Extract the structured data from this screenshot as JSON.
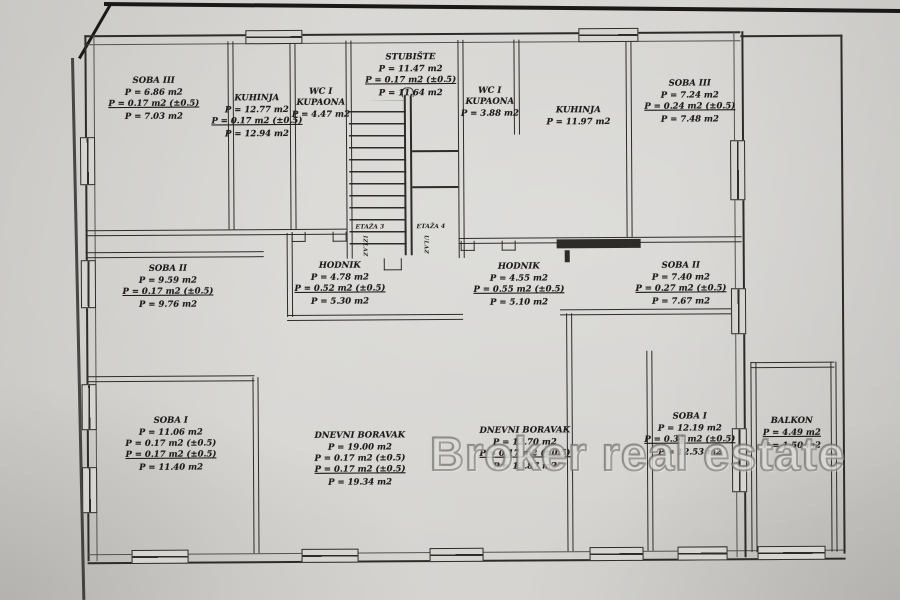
{
  "watermark": {
    "text": "Broker real estate"
  },
  "stairwell_annotations": {
    "left_floor": "ETAŽA 3",
    "left_dir": "IZLAZ",
    "right_floor": "ETAŽA 4",
    "right_dir": "ULAZ"
  },
  "rooms": {
    "soba3_left": {
      "name": "SOBA III",
      "lines": [
        "P = 6.86 m2",
        "P = 0.17 m2 (±0.5)",
        "P = 7.03 m2"
      ]
    },
    "kuhinja_left": {
      "name": "KUHINJA",
      "lines": [
        "P = 12.77 m2",
        "P = 0.17 m2 (±0.5)",
        "P = 12.94 m2"
      ]
    },
    "wc_left": {
      "name": "WC I\nKUPAONA",
      "lines": [
        "P = 4.47 m2"
      ]
    },
    "stubiste": {
      "name": "STUBIŠTE",
      "lines": [
        "P = 11.47 m2",
        "P = 0.17 m2 (±0.5)",
        "P = 11.64 m2"
      ]
    },
    "wc_right": {
      "name": "WC I\nKUPAONA",
      "lines": [
        "P = 3.88 m2"
      ]
    },
    "kuhinja_right": {
      "name": "KUHINJA",
      "lines": [
        "P = 11.97 m2"
      ]
    },
    "soba3_right": {
      "name": "SOBA III",
      "lines": [
        "P = 7.24 m2",
        "P = 0.24 m2 (±0.5)",
        "P = 7.48 m2"
      ]
    },
    "hodnik_left": {
      "name": "HODNIK",
      "lines": [
        "P = 4.78 m2",
        "P = 0.52 m2 (±0.5)",
        "P = 5.30 m2"
      ]
    },
    "hodnik_right": {
      "name": "HODNIK",
      "lines": [
        "P = 4.55 m2",
        "P = 0.55 m2 (±0.5)",
        "P = 5.10 m2"
      ]
    },
    "soba2_left": {
      "name": "SOBA II",
      "lines": [
        "P = 9.59 m2",
        "P = 0.17 m2 (±0.5)",
        "P = 9.76 m2"
      ]
    },
    "soba2_right": {
      "name": "SOBA II",
      "lines": [
        "P = 7.40 m2",
        "P = 0.27 m2 (±0.5)",
        "P = 7.67 m2"
      ]
    },
    "soba1_left": {
      "name": "SOBA I",
      "lines": [
        "P = 11.06 m2",
        "P = 0.17 m2 (±0.5)",
        "P = 0.17 m2 (±0.5)",
        "P = 11.40 m2"
      ]
    },
    "dnevni_left": {
      "name": "DNEVNI BORAVAK",
      "lines": [
        "P = 19.00 m2",
        "P = 0.17 m2 (±0.5)",
        "P = 0.17 m2 (±0.5)",
        "P = 19.34 m2"
      ]
    },
    "dnevni_right": {
      "name": "DNEVNI BORAVAK",
      "lines": [
        "P = 12.70 m2",
        "P = 0.17 m2 (±0.5)",
        "P = 12.87 m2"
      ]
    },
    "soba1_right": {
      "name": "SOBA I",
      "lines": [
        "P = 12.19 m2",
        "P = 0.34 m2 (±0.5)",
        "P = 12.53 m2"
      ]
    },
    "balkon": {
      "name": "BALKON",
      "lines": [
        "P = 4.49 m2",
        "P = 1.50 m2"
      ]
    }
  }
}
